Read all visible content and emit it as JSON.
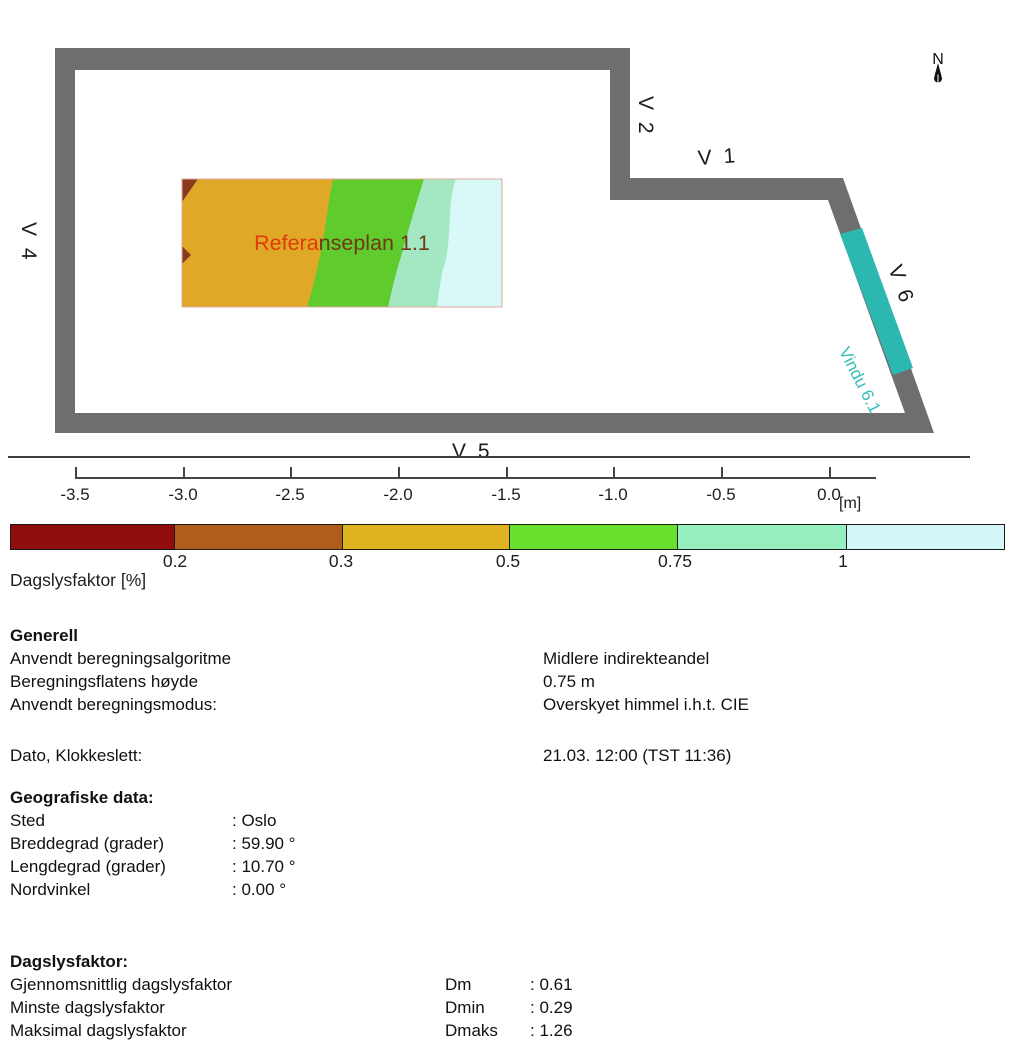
{
  "plan": {
    "compass_label": "N",
    "window_labels": {
      "v1": "V 1",
      "v2": "V 2",
      "v3": "V 3",
      "v4": "V 4",
      "v5": "V 5",
      "v6": "V 6"
    },
    "window_name_label": "Vindu 6.1",
    "title": {
      "text": "Referanseplan 1.1",
      "part1": "Refera",
      "part2": "nseplan 1.1",
      "color_part1": "#e13a0d",
      "color_part2": "#6e3a15"
    },
    "colors": {
      "wall": "#6e6e6e",
      "window_teal": "#2cb8b1",
      "map_gold": "#dfa826",
      "map_green": "#5fcb2d",
      "map_mint": "#a3e8c2",
      "map_cyan": "#d9f8f8",
      "map_darkred": "#8c3a1e",
      "map_border": "#dcab9e"
    }
  },
  "ruler": {
    "ticks": [
      "-3.5",
      "-3.0",
      "-2.5",
      "-2.0",
      "-1.5",
      "-1.0",
      "-0.5",
      "0.0"
    ],
    "unit": "[m]"
  },
  "legend": {
    "title": "Dagslysfaktor [%]",
    "boundary_labels": [
      "0.2",
      "0.3",
      "0.5",
      "0.75",
      "1"
    ],
    "colors": [
      "#8f0e0c",
      "#b05c1b",
      "#dfb31f",
      "#67e02e",
      "#96efbf",
      "#d3f7f8"
    ]
  },
  "sections": {
    "generell": {
      "heading": "Generell",
      "rows": [
        {
          "label": "Anvendt beregningsalgoritme",
          "value": "Midlere indirekteandel"
        },
        {
          "label": "Beregningsflatens høyde",
          "value": "0.75 m"
        },
        {
          "label": "Anvendt beregningsmodus:",
          "value": "Overskyet himmel i.h.t. CIE"
        },
        {
          "label": "Dato, Klokkeslett:",
          "value": "21.03.  12:00 (TST 11:36)"
        }
      ]
    },
    "geografiske": {
      "heading": "Geografiske data:",
      "rows": [
        {
          "label": "Sted",
          "value": ": Oslo"
        },
        {
          "label": "Breddegrad (grader)",
          "value": ": 59.90 °"
        },
        {
          "label": "Lengdegrad (grader)",
          "value": ": 10.70 °"
        },
        {
          "label": "Nordvinkel",
          "value": ": 0.00 °"
        }
      ]
    },
    "dagslysfaktor": {
      "heading": "Dagslysfaktor:",
      "rows": [
        {
          "label": "Gjennomsnittlig dagslysfaktor",
          "symbol": "Dm",
          "value": ": 0.61"
        },
        {
          "label": "Minste dagslysfaktor",
          "symbol": "Dmin",
          "value": ": 0.29"
        },
        {
          "label": "Maksimal dagslysfaktor",
          "symbol": "Dmaks",
          "value": ": 1.26"
        }
      ]
    }
  }
}
